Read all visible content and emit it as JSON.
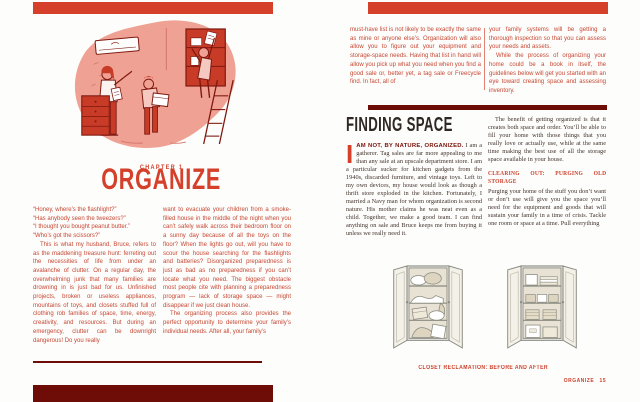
{
  "colors": {
    "accent_red": "#d5402b",
    "dark_maroon": "#6e0d08",
    "body_ink": "#42332b"
  },
  "left_page": {
    "chapter_label": "CHAPTER 1",
    "chapter_title": "ORGANIZE",
    "quotes": [
      "“Honey, where’s the flashlight?”",
      "“Has anybody seen the tweezers?”",
      "“I thought you bought peanut butter.”",
      "“Who’s got the scissors?”"
    ],
    "col1_para": "This is what my husband, Bruce, refers to as the maddening treasure hunt: ferreting out the necessities of life from under an avalanche of clutter. On a regular day, the overwhelming junk that many families are drowning in is just bad for us. Unfinished projects, broken or useless appliances, mountains of toys, and closets stuffed full of clothing rob families of space, time, energy, creativity, and resources. But during an emergency, clutter can be downright dangerous! Do you really",
    "col2_para1": "want to evacuate your children from a smoke-filled house in the middle of the night when you can’t safely walk across their bedroom floor on a sunny day because of all the toys on the floor? When the lights go out, will you have to scour the house searching for the flashlights and batteries? Disorganized preparedness is just as bad as no preparedness if you can’t locate what you need. The biggest obstacle most people cite with planning a preparedness program — lack of storage space — might disappear if we just clean house.",
    "col2_para2": "The organizing process also provides the perfect opportunity to determine your family’s individual needs. After all, your family’s"
  },
  "right_page": {
    "top_col1": "must-have list is not likely to be exactly the same as mine or anyone else’s. Organization will also allow you to figure out your equipment and storage-space needs. Having that list in hand will allow you pick up what you need when you find a good sale or, better yet, a tag sale or Freecycle find. In fact, all of",
    "top_col2_para1": "your family systems will be getting a thorough inspection so that you can assess your needs and assets.",
    "top_col2_para2": "While the process of organizing your home could be a book in itself, the guidelines below will get you started with an eye toward creating space and assessing inventory.",
    "section_heading": "FINDING SPACE",
    "drop_cap": "I",
    "lead_in": "AM NOT, BY NATURE, ORGANIZED.",
    "body_col1": "I am a gatherer. Tag sales are far more appealing to me than any sale at an upscale department store. I am a particular sucker for kitchen gadgets from the 1940s, discarded furniture, and vintage toys. Left to my own devices, my house would look as though a thrift store exploded in the kitchen. Fortunately, I married a Navy man for whom organization is second nature. His mother claims he was neat even as a child. Together, we make a good team. I can find anything on sale and Bruce keeps me from buying it unless we really need it.",
    "body_col2_para1": "The benefit of getting organized is that it creates both space and order. You’ll be able to fill your home with those things that you really love or actually use, while at the same time making the best use of all the storage space available in your house.",
    "subheading": "CLEARING OUT: PURGING OLD STORAGE",
    "body_col2_para2": "Purging your home of the stuff you don’t want or don’t use will give you the space you’ll need for the equipment and goods that will sustain your family in a time of crisis. Tackle one room or space at a time. Pull everything",
    "caption": "CLOSET RECLAMATION: BEFORE AND AFTER",
    "footer": {
      "label": "ORGANIZE",
      "page_number": "15"
    }
  }
}
